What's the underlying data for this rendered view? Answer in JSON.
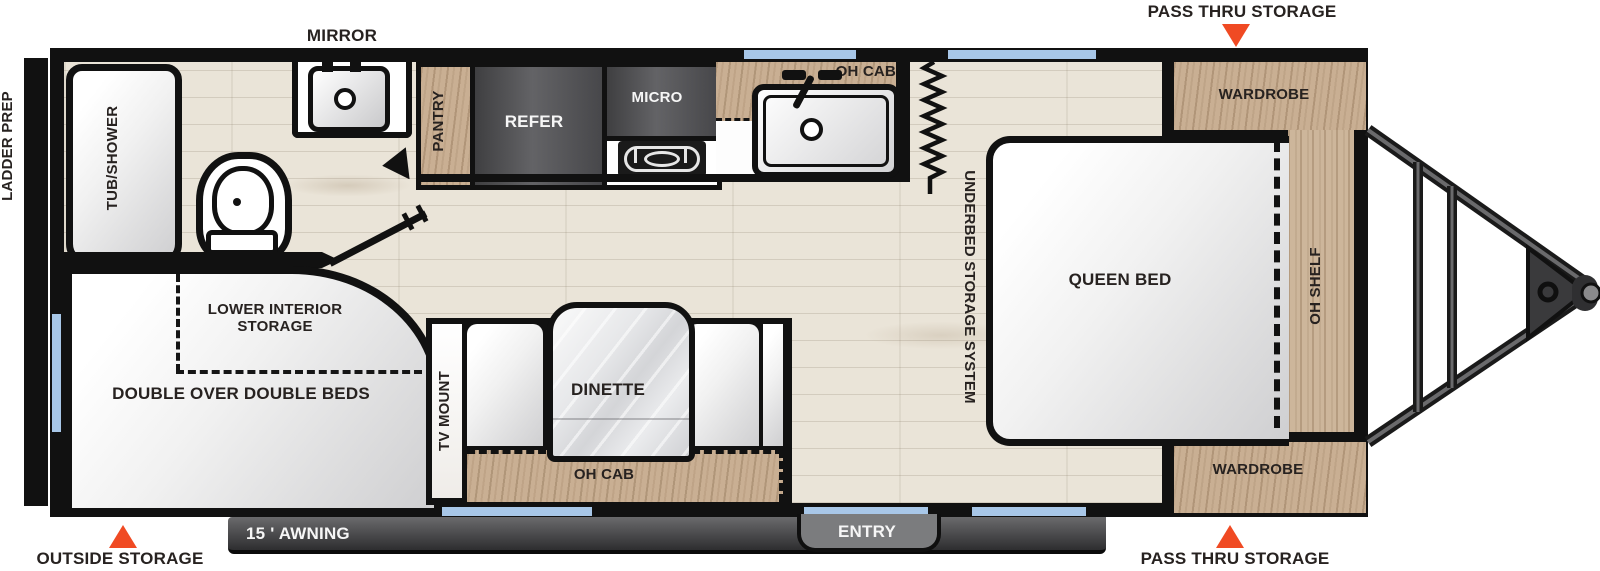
{
  "callouts": {
    "mirror": "MIRROR",
    "pass_thru_storage_top": "PASS THRU STORAGE",
    "pass_thru_storage_bottom": "PASS THRU STORAGE",
    "outside_storage": "OUTSIDE STORAGE",
    "ladder_prep": "LADDER PREP",
    "awning": "15 ' AWNING",
    "entry": "ENTRY"
  },
  "bathroom": {
    "tub_shower": "TUB/SHOWER"
  },
  "kitchen": {
    "pantry": "PANTRY",
    "refrigerator": "REFER",
    "microwave": "MICRO",
    "overhead_cabinet": "OH CAB"
  },
  "bedroom": {
    "queen_bed": "QUEEN BED",
    "underbed_storage": "UNDERBED STORAGE SYSTEM",
    "overhead_shelf": "OH SHELF",
    "wardrobe_roadside": "WARDROBE",
    "wardrobe_doorside": "WARDROBE"
  },
  "bunk_room": {
    "lower_interior_storage": "LOWER INTERIOR STORAGE",
    "double_over_double_beds": "DOUBLE OVER DOUBLE BEDS",
    "tv_mount": "TV MOUNT"
  },
  "dinette_area": {
    "dinette": "DINETTE",
    "overhead_cabinet": "OH CAB"
  },
  "colors": {
    "accent_orange": "#F04A23",
    "window_blue": "#A8C7E8",
    "cabinet_wood": "#C9AF93",
    "appliance_dark": "#4A4A4C",
    "wall_black": "#111111"
  }
}
